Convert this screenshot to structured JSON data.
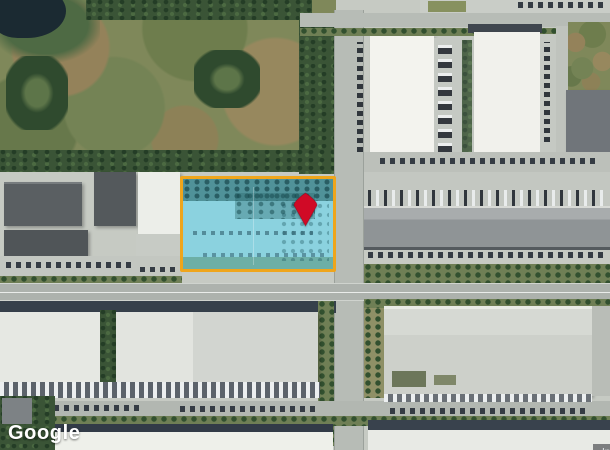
{
  "map": {
    "view_type": "satellite",
    "parcel_overlay": {
      "label": "highlighted-parcel-boundary",
      "border_color": "#EFA51B",
      "fill_color": "rgba(126, 211, 229, 0.82)"
    },
    "pin": {
      "label": "property-location-pin",
      "color": "#D00A26"
    }
  },
  "footer": {
    "google_logo": "Google",
    "attribution": "Imagery ©2025 Airbus, Maxar Technologies"
  }
}
